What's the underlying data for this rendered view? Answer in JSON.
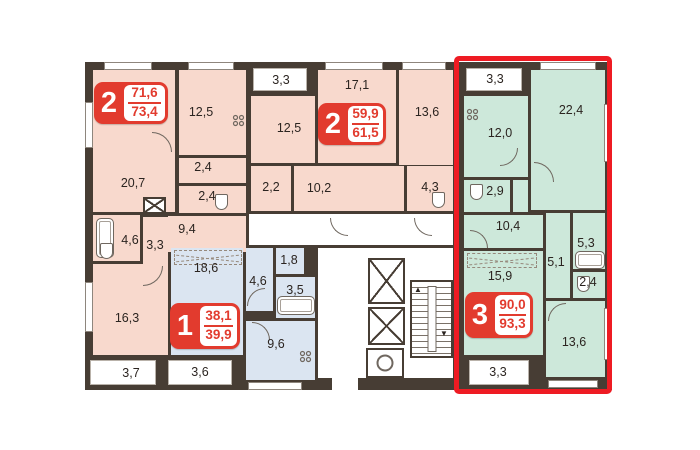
{
  "title": "apartment-floor-plan",
  "colors": {
    "wall": "#473d34",
    "apartment_pink": "#f8d9cd",
    "apartment_blue": "#dbe5f1",
    "apartment_green": "#cde8da",
    "badge_red": "#e23b2e",
    "highlight_red": "#ee1b23",
    "common_area": "#ffffff"
  },
  "apartments": [
    {
      "id": "apt-2-left",
      "color": "#f8d9cd",
      "badge": {
        "number": "2",
        "area_top": "71,6",
        "area_bottom": "73,4"
      },
      "rooms": [
        {
          "name": "living-room",
          "area": "20,7"
        },
        {
          "name": "kitchen",
          "area": "12,5"
        },
        {
          "name": "bathroom",
          "area": "2,4"
        },
        {
          "name": "wc",
          "area": "2,4"
        },
        {
          "name": "hall",
          "area": "9,4"
        },
        {
          "name": "bathroom-2",
          "area": "4,6"
        },
        {
          "name": "hall-2",
          "area": "3,3"
        },
        {
          "name": "bedroom",
          "area": "16,3"
        },
        {
          "name": "balcony",
          "area": "3,7"
        }
      ]
    },
    {
      "id": "apt-2-middle",
      "color": "#f8d9cd",
      "badge": {
        "number": "2",
        "area_top": "59,9",
        "area_bottom": "61,5"
      },
      "rooms": [
        {
          "name": "balcony",
          "area": "3,3"
        },
        {
          "name": "kitchen",
          "area": "12,5"
        },
        {
          "name": "living-room",
          "area": "17,1"
        },
        {
          "name": "bedroom",
          "area": "13,6"
        },
        {
          "name": "bathroom",
          "area": "2,2"
        },
        {
          "name": "hall",
          "area": "10,2"
        },
        {
          "name": "bathroom-2",
          "area": "4,3"
        }
      ]
    },
    {
      "id": "apt-1-blue",
      "color": "#dbe5f1",
      "badge": {
        "number": "1",
        "area_top": "38,1",
        "area_bottom": "39,9"
      },
      "rooms": [
        {
          "name": "living-room",
          "area": "18,6"
        },
        {
          "name": "hall",
          "area": "4,6"
        },
        {
          "name": "storage",
          "area": "1,8"
        },
        {
          "name": "bathroom",
          "area": "3,5"
        },
        {
          "name": "kitchen",
          "area": "9,6"
        },
        {
          "name": "balcony",
          "area": "3,6"
        }
      ]
    },
    {
      "id": "apt-3-green-selected",
      "color": "#cde8da",
      "selected": true,
      "badge": {
        "number": "3",
        "area_top": "90,0",
        "area_bottom": "93,3"
      },
      "rooms": [
        {
          "name": "balcony",
          "area": "3,3"
        },
        {
          "name": "kitchen",
          "area": "12,0"
        },
        {
          "name": "living-room",
          "area": "22,4"
        },
        {
          "name": "bathroom",
          "area": "2,9"
        },
        {
          "name": "hall",
          "area": "10,4"
        },
        {
          "name": "bedroom",
          "area": "15,9"
        },
        {
          "name": "hall-2",
          "area": "5,1"
        },
        {
          "name": "bathroom-2",
          "area": "5,3"
        },
        {
          "name": "wc",
          "area": "2,4"
        },
        {
          "name": "bedroom-2",
          "area": "13,6"
        },
        {
          "name": "balcony-2",
          "area": "3,3"
        }
      ]
    }
  ]
}
